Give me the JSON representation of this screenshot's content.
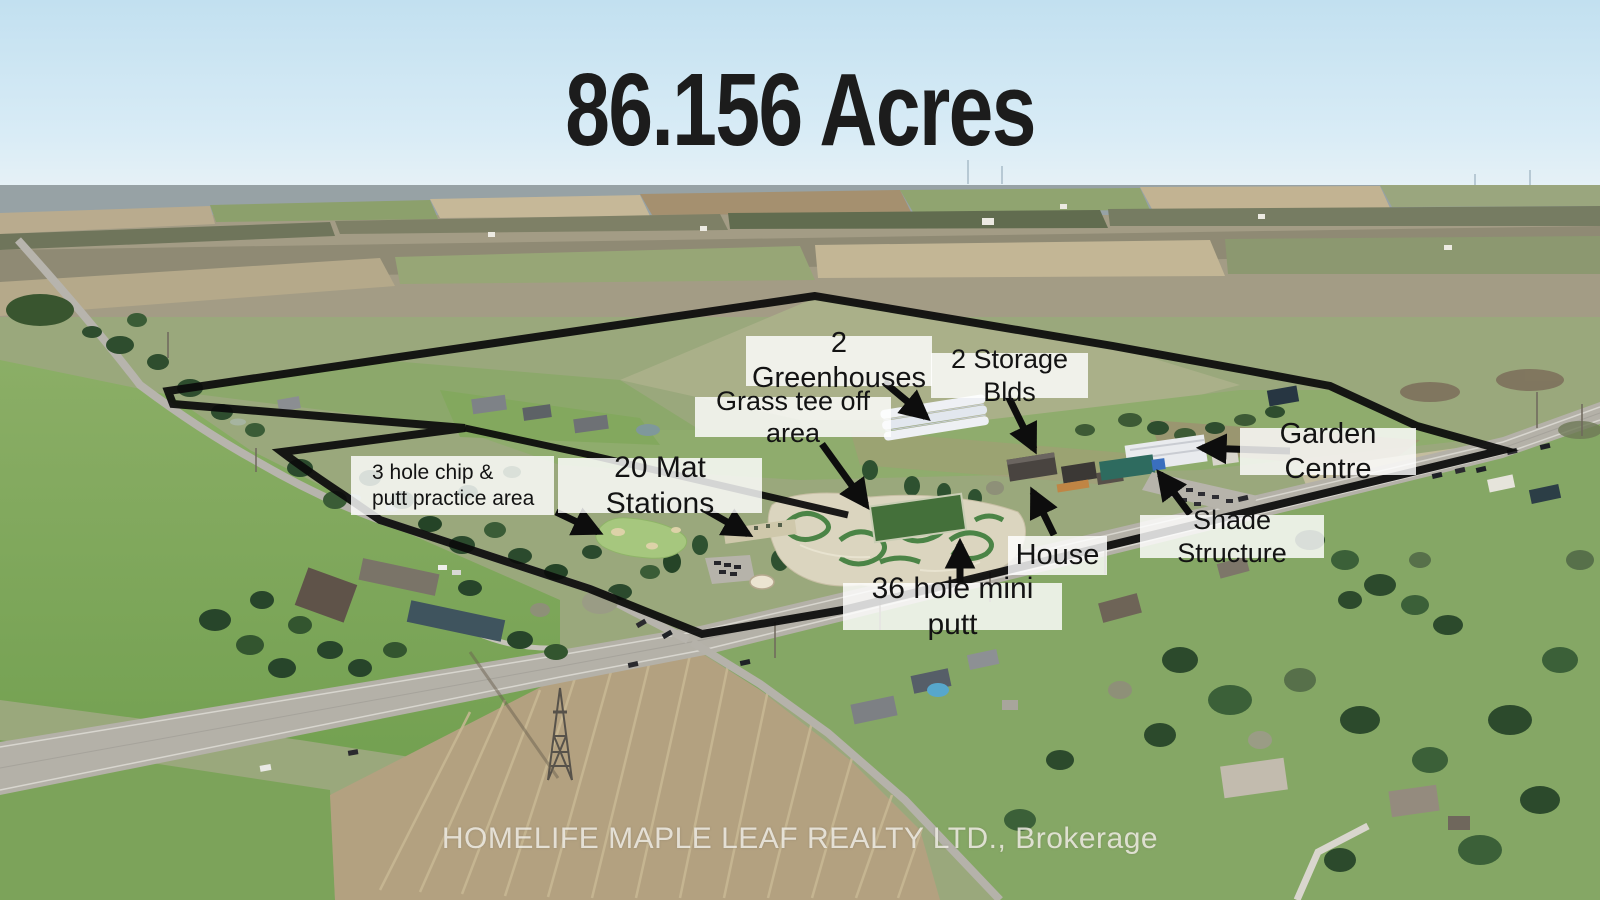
{
  "title": "86.156 Acres",
  "watermark": "HOMELIFE MAPLE LEAF REALTY LTD., Brokerage",
  "labels": {
    "greenhouses": "2 Greenhouses",
    "storage_buildings": "2 Storage Blds",
    "grass_tee": "Grass tee off area",
    "chip_putt_line1": "3 hole chip  &",
    "chip_putt_line2": "putt practice area",
    "mat_stations": "20 Mat Stations",
    "garden_centre": "Garden Centre",
    "shade_structure": "Shade Structure",
    "house": "House",
    "mini_putt": "36 hole mini putt"
  },
  "colors": {
    "boundary_line": "#0b0b0b",
    "annotation_arrow": "#0d0d0d",
    "label_background": "rgba(255,255,255,0.82)",
    "label_text": "#131313",
    "title_text": "#1c1c1c",
    "watermark_text": "#f3f0e9"
  }
}
